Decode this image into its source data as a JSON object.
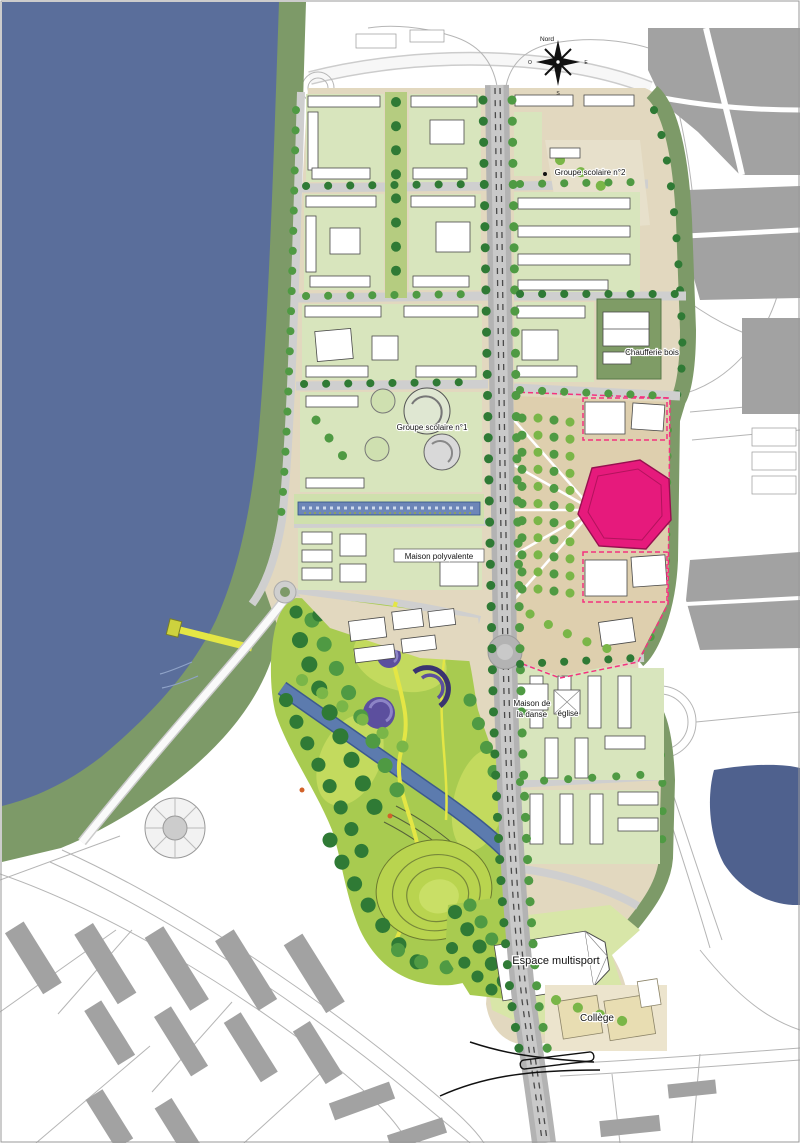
{
  "labels": {
    "groupe_scolaire_2": "Groupe scolaire n°2",
    "chaufferie_bois": "Chaufferie bois",
    "groupe_scolaire_1": "Groupe scolaire n°1",
    "maison_polyvalente": "Maison polyvalente",
    "maison_danse_l1": "Maison de",
    "maison_danse_l2": "la danse",
    "eglise": "église",
    "espace_multisport": "Espace multisport",
    "college": "Collège",
    "compass_n": "Nord",
    "compass_s": "S",
    "compass_o": "O",
    "compass_e": "E"
  },
  "colors": {
    "river": "#5a6e9b",
    "dock": "#4f618e",
    "riverbank": "#7d9a68",
    "park": "#a8cb50",
    "park_light": "#c3da5e",
    "lawn_pale": "#d8e5bd",
    "ground": "#e2d8bf",
    "ground_tan": "#decfae",
    "road": "#cfcfcf",
    "boulevard": "#b3b3b3",
    "building": "#ffffff",
    "outline": "#4a4a4a",
    "context_building": "#a2a2a2",
    "context_line": "#b5b5b5",
    "tree_dark": "#2f7a35",
    "tree_mid": "#4f9a43",
    "tree_light": "#7ab648",
    "canal": "#5c7bae",
    "water_garden": "#6d86b8",
    "highlight": "#e61a7c",
    "highlight_dash": "#f4327f",
    "purple": "#5c4f9e",
    "path_yellow": "#e4e645"
  }
}
